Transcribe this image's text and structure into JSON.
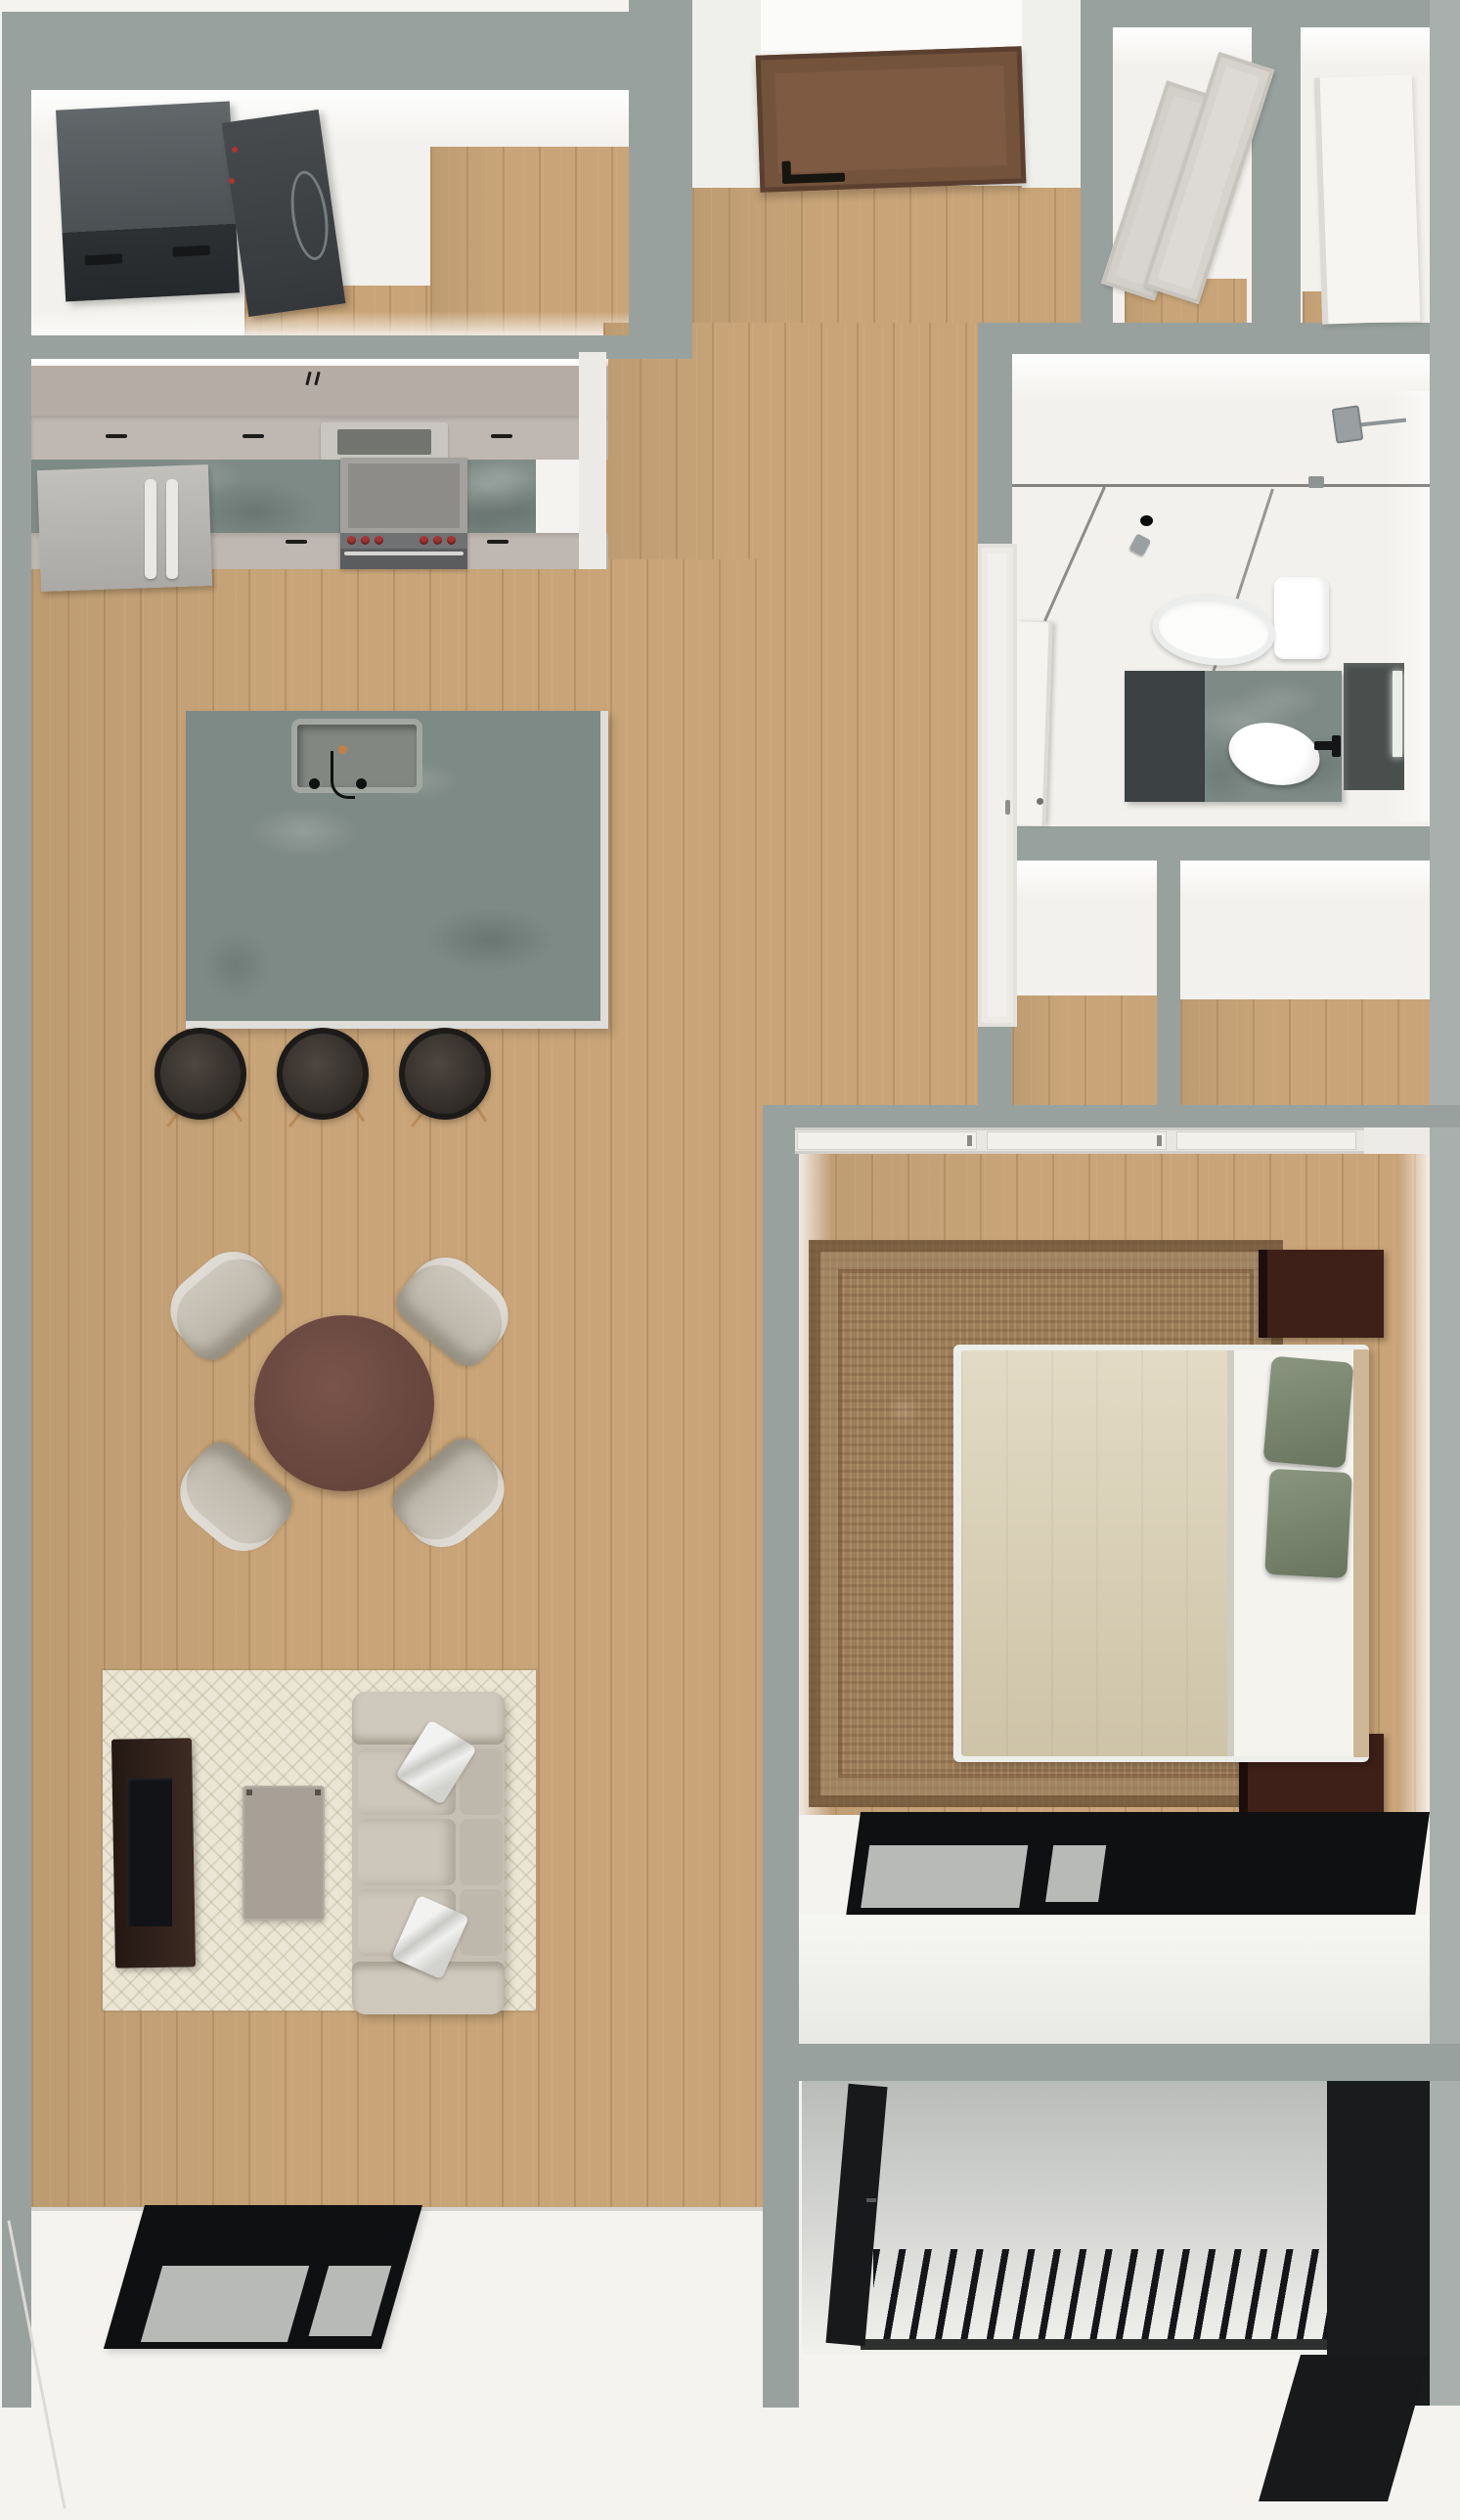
{
  "meta": {
    "description": "Top-down 3D rendered floor plan of a one-bedroom apartment with kitchen, dining, living room, bedroom, bathroom, laundry room, closets and two balconies",
    "view": "overhead dollhouse render",
    "no_visible_text": true
  },
  "style": {
    "root_style": "--ext:#f4f3f0;--wall:#99a19e;--wall-light:#a9afac;--white-floor:#f2f1ed;--wood:#c8a478;--stone:#7e8a86;--greige:#b5aca6;--greige-front:#bfb7b1;--fridge:#b4b2af;--stove-front:#5a5c5e;--knob:#a83434;--stool:#443d37;--table:#6f4b41;--chair:#c9c4ba;--rug:#ebe5d5;--rug-line:rgba(150,140,110,.22);--sofa:#c6bfb3;--sofa-light:#cfc8bc;--console:#342520;--screen:#111317;--coffee:#a8a096;--frame:#0e1012;--pane:#b7bab7;--bedrug:#9d7c59;--duvet:#d9ceb1;--sheet:#f4f3ee;--sage:#7e8a77;--headboard:#cdb796;--nightstand:#3f2018;--balcony-dark:#191b1d;--door:#7d5a41;--door-dark:#5b4030;--closet-door:#d8d5d0"
  },
  "palette": {
    "wall_cap": "#99a19e",
    "wood_floor": "#c8a478",
    "white_floor": "#f2f1ed",
    "stone_counter": "#7e8a86",
    "cabinet_greige": "#b5aca6",
    "stove_knob_red": "#a83434",
    "dining_table_brown": "#6f4b41",
    "living_rug_cream": "#ebe5d5",
    "sofa_taupe": "#c6bfb3",
    "tv_console_brown": "#342520",
    "bedroom_rug_brown": "#9d7c59",
    "duvet_beige": "#d9ceb1",
    "pillow_sage": "#7e8a77",
    "nightstand_brown": "#3f2018",
    "window_frame_black": "#0e1012",
    "entry_door_brown": "#7d5a41",
    "balcony_railing_black": "#141619"
  },
  "rooms": [
    {
      "id": "laundry",
      "name": "Laundry room",
      "furniture": [
        "washer",
        "dryer"
      ]
    },
    {
      "id": "entry",
      "name": "Entry hall",
      "furniture": [
        "entry-door"
      ]
    },
    {
      "id": "closet-a",
      "name": "Hall closet with sliding doors",
      "furniture": [
        "sliding-door-panels"
      ]
    },
    {
      "id": "closet-b",
      "name": "Hall closet with wardrobe",
      "furniture": [
        "white-wardrobe"
      ]
    },
    {
      "id": "bathroom",
      "name": "Bathroom",
      "furniture": [
        "walk-in-shower",
        "shower-head",
        "floor-drain",
        "shower-control",
        "glass-partition",
        "toilet",
        "vanity-cabinet",
        "stone-vanity-top",
        "vessel-sink",
        "black-faucet",
        "mirror",
        "sconce-light",
        "bathroom-door",
        "linen-closet"
      ]
    },
    {
      "id": "kitchen",
      "name": "Kitchen",
      "furniture": [
        "upper-cabinets",
        "microwave",
        "range-with-red-knobs",
        "oven",
        "refrigerator",
        "stone-counters",
        "island",
        "island-sink",
        "bar-stool-1",
        "bar-stool-2",
        "bar-stool-3"
      ]
    },
    {
      "id": "dining",
      "name": "Dining area",
      "furniture": [
        "round-table",
        "chair-nw",
        "chair-ne",
        "chair-sw",
        "chair-se"
      ]
    },
    {
      "id": "living",
      "name": "Living room",
      "furniture": [
        "area-rug",
        "sofa",
        "throw-pillow-1",
        "throw-pillow-2",
        "coffee-table",
        "tv-console",
        "tv",
        "window"
      ]
    },
    {
      "id": "bedroom",
      "name": "Bedroom",
      "furniture": [
        "sliding-doors",
        "area-rug",
        "bed",
        "duvet",
        "pillow-sage-1",
        "pillow-sage-2",
        "headboard",
        "nightstand-1",
        "nightstand-2",
        "window"
      ]
    },
    {
      "id": "alcove",
      "name": "Hall alcoves / closets",
      "furniture": []
    },
    {
      "id": "balcony-bedroom",
      "name": "Bedroom balcony",
      "furniture": [
        "slat-railing",
        "balcony-door"
      ]
    },
    {
      "id": "exterior",
      "name": "Exterior ledge",
      "furniture": []
    }
  ],
  "counts": {
    "bar_stools": 3,
    "dining_chairs": 4,
    "nightstands": 2,
    "sofa_seats": 3,
    "bed_pillows": 2
  }
}
